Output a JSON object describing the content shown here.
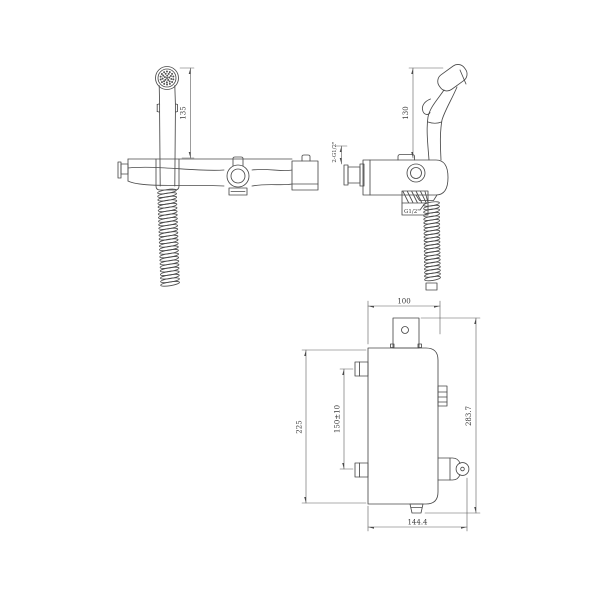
{
  "drawing": {
    "type": "technical-drawing",
    "subject": "wall-mounted faucet with handheld bidet sprayer, three orthographic views",
    "colors": {
      "background": "#ffffff",
      "line": "#4a4a4a",
      "text": "#3a3a3a"
    },
    "views": {
      "front": {
        "name": "front view",
        "sprayer_height": "135"
      },
      "side": {
        "name": "side view",
        "sprayer_height": "130",
        "inlet_thread": "2-G1/2\"",
        "hose_thread": "G1/2\""
      },
      "plan": {
        "name": "mounting plan view",
        "top_width": "100",
        "body_height": "225",
        "mount_spacing": "150±10",
        "total_height": "283.7",
        "total_width": "144.4"
      }
    }
  }
}
